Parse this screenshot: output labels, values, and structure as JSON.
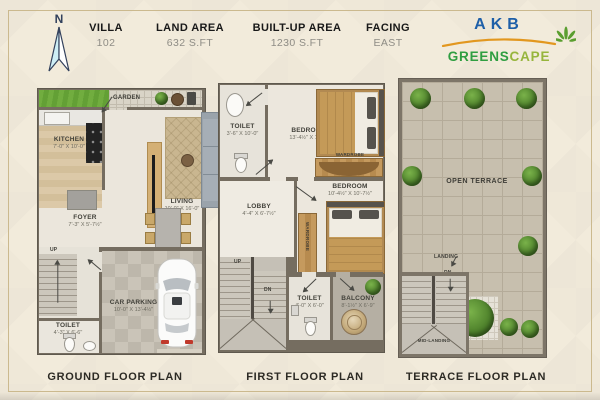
{
  "header": {
    "north": "N",
    "fields": [
      {
        "label": "VILLA",
        "value": "102"
      },
      {
        "label": "LAND AREA",
        "value": "632 S.FT"
      },
      {
        "label": "BUILT-UP AREA",
        "value": "1230 S.FT"
      },
      {
        "label": "FACING",
        "value": "EAST"
      }
    ],
    "logo": {
      "name": "AKB",
      "sub_green": "GREENS",
      "sub_gold": "CAPE"
    }
  },
  "colors": {
    "logo_blue": "#1e5fa8",
    "logo_green": "#2f9e41",
    "logo_gold": "#97b53c",
    "swoosh_orange": "#e2971f",
    "wall": "#756d60",
    "background_cream": "#f2ebdb"
  },
  "ground": {
    "caption": "GROUND FLOOR PLAN",
    "garden": "GARDEN",
    "kitchen": {
      "name": "KITCHEN",
      "dim": "7'-0\" X 10'-0\""
    },
    "living": {
      "name": "LIVING",
      "dim": "10'-0\" X 16'-0\""
    },
    "foyer": {
      "name": "FOYER",
      "dim": "7'-3\" X 5'-7½\""
    },
    "toilet": {
      "name": "TOILET",
      "dim": "4'-3\" X 6'-6\""
    },
    "parking": {
      "name": "CAR PARKING",
      "dim": "10'-0\" X 13'-4½\""
    },
    "up": "UP"
  },
  "first": {
    "caption": "FIRST FLOOR PLAN",
    "toilet_top": {
      "name": "TOILET",
      "dim": "3'-6\" X 10'-0\""
    },
    "bedroom1": {
      "name": "BEDROOM",
      "dim": "13'-4½\" X 10'-0\""
    },
    "wardrobe1": "WARDROBE",
    "bedroom2": {
      "name": "BEDROOM",
      "dim": "10'-4½\" X 10'-7½\""
    },
    "wardrobe2": "WARDROBE",
    "lobby": {
      "name": "LOBBY",
      "dim": "4'-4\" X 6'-7½\""
    },
    "up": "UP",
    "dn": "DN",
    "toilet_bottom": {
      "name": "TOILET",
      "dim": "4'-0\" X 6'-0\""
    },
    "balcony": {
      "name": "BALCONY",
      "dim": "8'-1½\" X 6'-9\""
    }
  },
  "terrace": {
    "caption": "TERRACE FLOOR PLAN",
    "open_terrace": "OPEN TERRACE",
    "landing": "LANDING",
    "dn": "DN",
    "mid_landing": "MID-LANDING"
  }
}
